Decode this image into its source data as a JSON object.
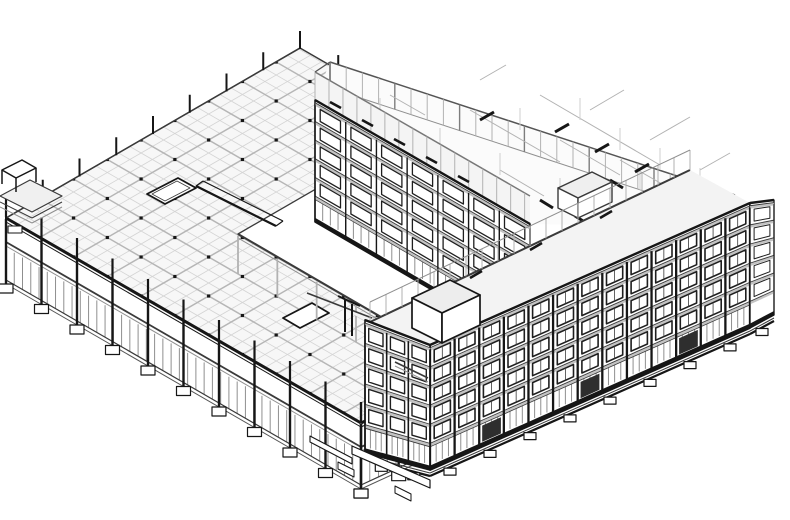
{
  "view": {
    "kind": "architectural-3d-hidden-line-view",
    "projection": "axonometric",
    "background": "#ffffff",
    "description": "Monochrome BIM-style 3D view of a perimeter-block building around a central courtyard. Left: low structural concrete podium shown as halftone beam grid with columns, storefront glazing and strip footings. Right: L-shaped six-storey wings with punched-window facades; the top storey is cut open showing halftone partition walls; two rooftop stair/elevator bulkheads; exposed stepped footings below grade."
  },
  "colors": {
    "white": "#ffffff",
    "ink": "#161616",
    "inkMid": "#3a3a3a",
    "inkSoft": "#555555",
    "winFrame": "#1f1f1f",
    "spandrel": "#c3c3c3",
    "mullion": "#8f8f8f",
    "half": "#b2b2b2",
    "halfLight": "#cfcfcf",
    "gridFine": "#d4d4d4",
    "gridMajor": "#b6b6b6",
    "fillRoof": "#f3f3f3",
    "fillOpen": "#fbfbfb",
    "fillBand": "#f4f4f4",
    "fillSlab": "#f7f7f7",
    "darkPanel": "#2e2e2e"
  },
  "elements": [
    {
      "name": "podium-structural-frame",
      "style": "halftone beam grid, column dots, shaft openings"
    },
    {
      "name": "podium-storefront-level",
      "style": "grey mullions below slab edge"
    },
    {
      "name": "podium-strip-footings",
      "style": "black outlined blocks at grade"
    },
    {
      "name": "courtyard",
      "style": "open white ground"
    },
    {
      "name": "northeast-wing-facade",
      "style": "5 window rows over storefront"
    },
    {
      "name": "southeast-wing-facade",
      "style": "13 bays, black piers, 5 window rows over storefront"
    },
    {
      "name": "southeast-wing-end-facade",
      "style": "3 bays"
    },
    {
      "name": "east-return-facade",
      "style": "1 bay"
    },
    {
      "name": "open-top-storey",
      "style": "halftone perimeter walls and partitions, roof cut away"
    },
    {
      "name": "roof-bulkhead-south",
      "style": "dark-edged box on roof"
    },
    {
      "name": "roof-bulkhead-north",
      "style": "dark-edged box among halftone walls"
    },
    {
      "name": "site-steps-west-tip",
      "style": "small platform and stair at far left"
    }
  ]
}
